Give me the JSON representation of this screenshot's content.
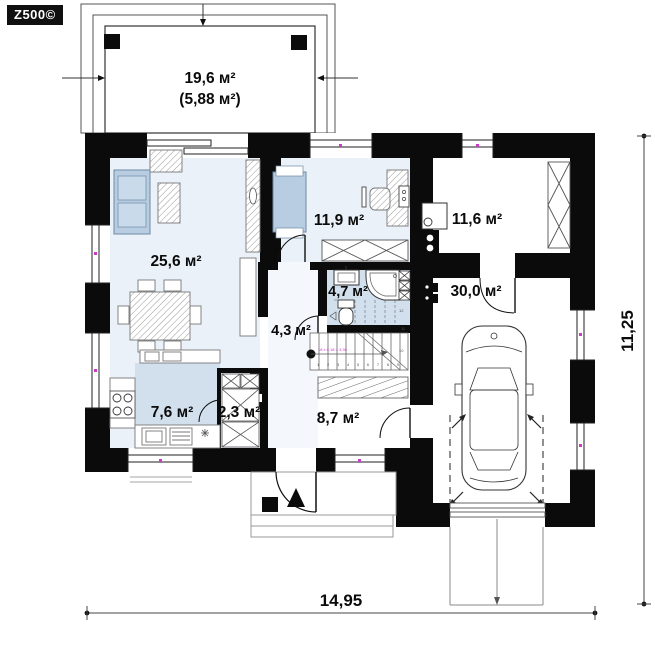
{
  "logo": {
    "brand": "Z500©"
  },
  "rooms": {
    "terrace": {
      "area": "19,6 м²",
      "area_secondary": "(5,88 м²)"
    },
    "living": {
      "area": "25,6 м²"
    },
    "bedroom": {
      "area": "11,9 м²"
    },
    "utility": {
      "area": "11,6 м²"
    },
    "bathroom": {
      "area": "4,7 м²"
    },
    "corridor": {
      "area": "4,3 м²"
    },
    "garage": {
      "area": "30,0 м²"
    },
    "kitchen": {
      "area": "7,6 м²"
    },
    "pantry": {
      "area": "2,3 м²"
    },
    "hall": {
      "area": "8,7 м²"
    }
  },
  "stairs": {
    "annotation": "18 x 0,18 = 3,30",
    "lower_tread_numbers": "1 2 3 4 5 6 7 8 9",
    "upper_tread_numbers": {
      "t10": "10",
      "t11": "11",
      "t12": "12"
    }
  },
  "dimensions": {
    "overall_width": "14,95",
    "overall_height": "11,25"
  },
  "colors": {
    "wall": "#0b0b0b",
    "room_tint": "#ebf1f8",
    "wet_room_tint": "#d2e0ee",
    "furniture_blue": "#b9cde2",
    "marker_magenta": "#c73bc7"
  }
}
